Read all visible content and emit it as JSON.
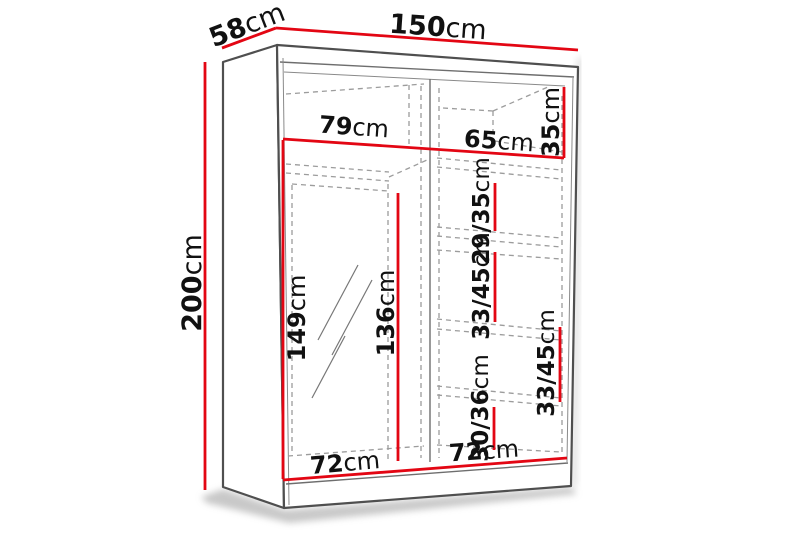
{
  "diagram": {
    "type": "wardrobe-dimension-diagram",
    "unit": "cm",
    "colors": {
      "dimension_red": "#e30613",
      "outline_gray": "#4f4f4f",
      "dashed_gray": "#9c9c9c",
      "text_black": "#111111",
      "background": "#ffffff"
    },
    "dimensions": {
      "overall_width": {
        "num": "150",
        "unit": "cm"
      },
      "overall_depth": {
        "num": "58",
        "unit": "cm"
      },
      "overall_height": {
        "num": "200",
        "unit": "cm"
      },
      "left_compartment_width": {
        "num": "79",
        "unit": "cm"
      },
      "right_compartment_width": {
        "num": "65",
        "unit": "cm"
      },
      "top_shelf_height": {
        "num": "35",
        "unit": "cm"
      },
      "upper_shelf_height": {
        "num": "29/35",
        "unit": "cm"
      },
      "middle_shelf_height_left": {
        "num": "33/45",
        "unit": "cm"
      },
      "middle_shelf_height_right": {
        "num": "33/45",
        "unit": "cm"
      },
      "mirror_door_height": {
        "num": "149",
        "unit": "cm"
      },
      "hanging_space_height": {
        "num": "136",
        "unit": "cm"
      },
      "lower_shelf_height": {
        "num": "30/36",
        "unit": "cm"
      },
      "left_door_width": {
        "num": "72",
        "unit": "cm"
      },
      "right_door_width": {
        "num": "72",
        "unit": "cm"
      }
    }
  }
}
